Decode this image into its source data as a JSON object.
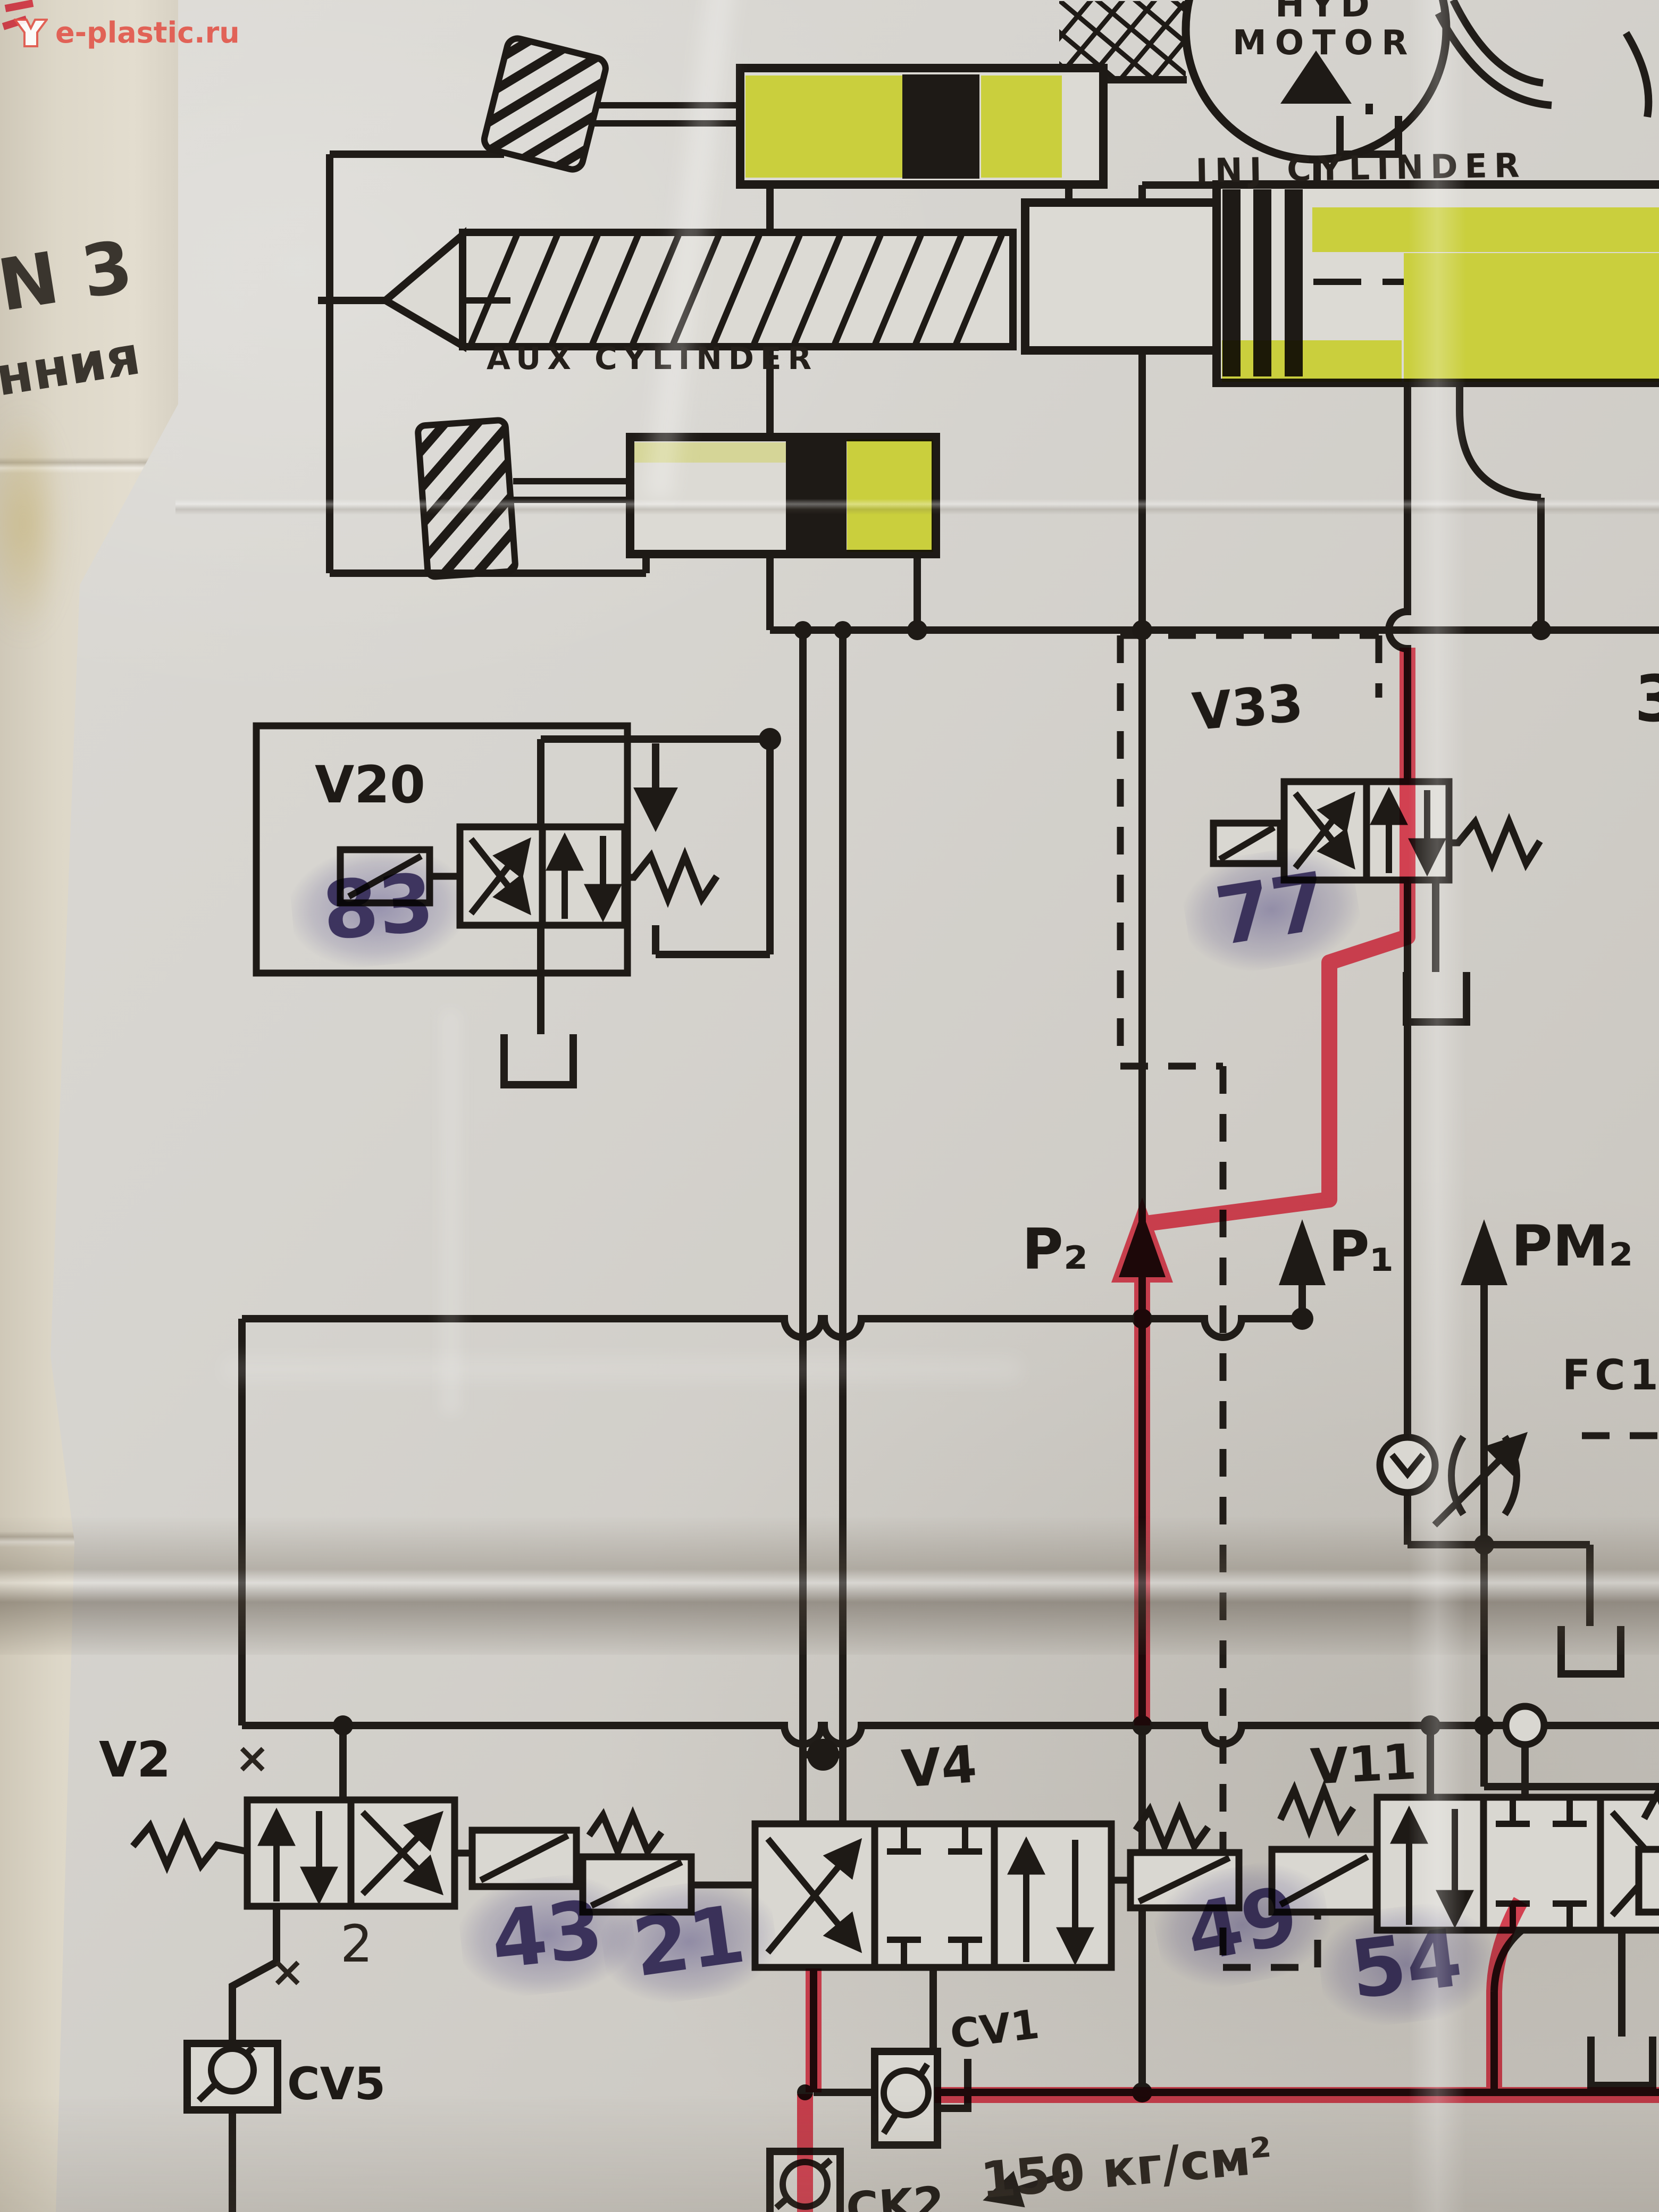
{
  "colors": {
    "ink": "#201c18",
    "paper": "#d9d7d1",
    "highlight_yellow": "#e8f128",
    "highlight_red": "#f5203a",
    "stamp_purple": "#483e74",
    "watermark_red": "#e2554a"
  },
  "watermark": {
    "text": "e-plastic.ru"
  },
  "side_sheet": {
    "doc_no": "N 3",
    "cyrillic_fragment": "нния"
  },
  "labels": {
    "hyd": "HYD",
    "motor": "MOTOR",
    "inj_cylinder": "INJ CYLINDER",
    "aux_cylinder": "AUX CYLINDER",
    "v20": "V20",
    "v33": "V33",
    "v2": "V2",
    "v4": "V4",
    "v11": "V11",
    "p2": "P₂",
    "p1": "P₁",
    "pm2": "PM₂",
    "fc1": "FC1",
    "cv5": "CV5",
    "cv1": "CV1",
    "ck2": "CK2",
    "edge_digit": "3"
  },
  "stamps": {
    "v20": "83",
    "v33": "77",
    "v2": "43",
    "v4_left": "21",
    "v4_right": "49",
    "v11": "54"
  },
  "annotations": {
    "pressure": "150 кг/см²",
    "digit2": "2",
    "x_mark": "×"
  }
}
